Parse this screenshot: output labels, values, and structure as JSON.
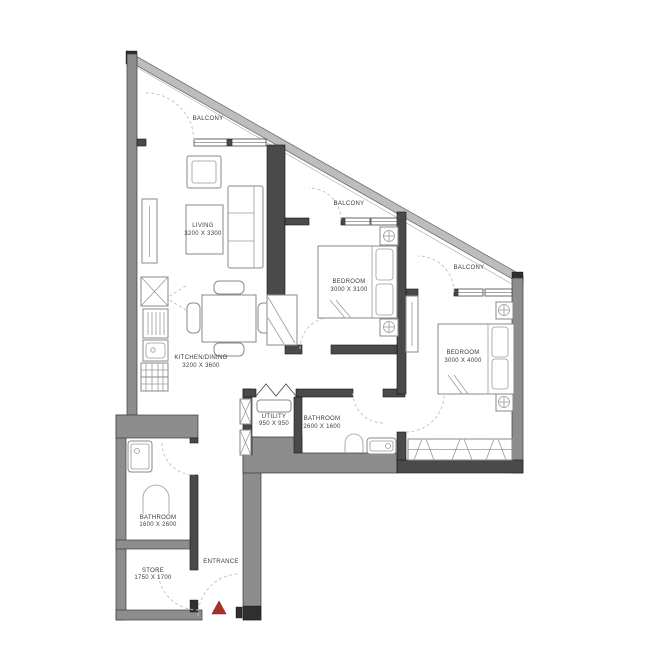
{
  "rooms": [
    {
      "name": "BALCONY"
    },
    {
      "name": "LIVING",
      "dims": "3200 X 3300"
    },
    {
      "name": "BALCONY"
    },
    {
      "name": "BEDROOM",
      "dims": "3000 X 3100"
    },
    {
      "name": "BALCONY"
    },
    {
      "name": "BEDROOM",
      "dims": "3000 X 4000"
    },
    {
      "name": "KITCHEN/DINING",
      "dims": "3200 X 3600"
    },
    {
      "name": "UTILITY",
      "dims": "950 X 950"
    },
    {
      "name": "BATHROOM",
      "dims": "2600 X 1600"
    },
    {
      "name": "BATHROOM",
      "dims": "1600 X 2600"
    },
    {
      "name": "STORE",
      "dims": "1750 X 1700"
    },
    {
      "name": "ENTRANCE"
    }
  ],
  "colors": {
    "wall_dark": "#4a4a4a",
    "wall_gray": "#8d8d8d",
    "balcony_wall": "#bdbdbd",
    "furniture_line": "#8a8a8a",
    "door_swing": "#c0c0c0",
    "label_text": "#3a3a3a",
    "entrance_marker": "#a93226",
    "floor": "#ffffff"
  }
}
